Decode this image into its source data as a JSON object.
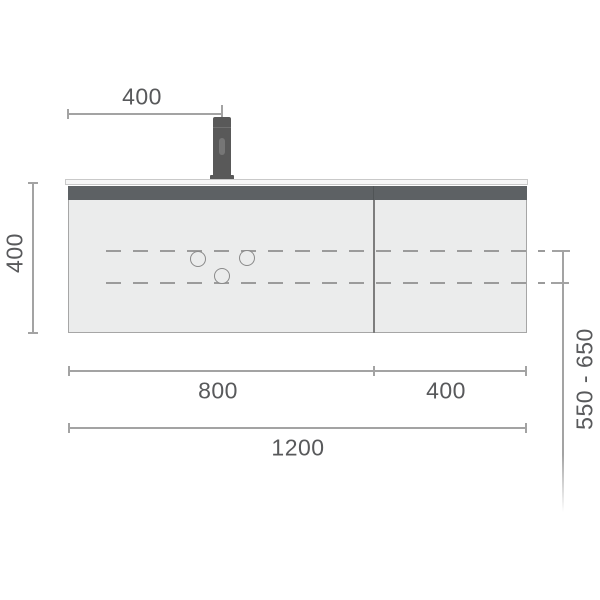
{
  "diagram": {
    "title": "vanity-cabinet-front-elevation-technical-drawing",
    "dimensions": {
      "tap_offset": "400",
      "cabinet_height": "400",
      "left_section_width": "800",
      "right_section_width": "400",
      "total_width": "1200",
      "drain_height_range": "550 - 650"
    },
    "features": {
      "drain_holes_count": "3",
      "sections_count": "2"
    },
    "colors": {
      "background": "#ffffff",
      "cabinet_body": "#ebecec",
      "cabinet_outline": "#a6a6a6",
      "top_band": "#5d6164",
      "countertop": "#f6f6f6",
      "faucet": "#595959",
      "dashed_line": "#9b9b9b",
      "dimension_line": "#a3a3a3",
      "dimension_text": "#58595b"
    }
  }
}
